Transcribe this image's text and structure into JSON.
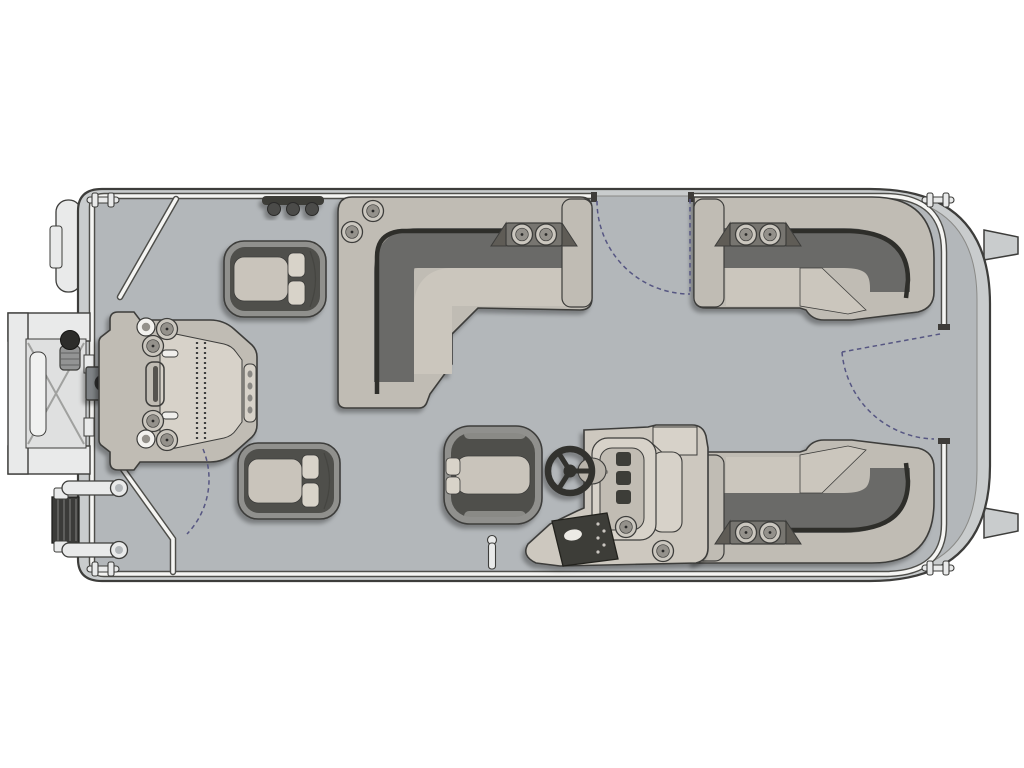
{
  "diagram": {
    "title": "Pontoon boat floor plan — overhead deck layout, bow at left",
    "view": "top-down"
  },
  "colors": {
    "bg": "#ffffff",
    "outline": "#3d3d3b",
    "seamDark": "#2d2d2b",
    "hull": "#c9cccd",
    "deck": "#b3b7ba",
    "deckEdge": "#8a8a87",
    "railWhite": "#f5f5f3",
    "railEdge": "#4e4e4a",
    "base": "#c0bcb4",
    "seat": "#cbc6bd",
    "back": "#6b6a67",
    "shell": "#90908d",
    "wrap": "#4f4f4c",
    "cushion": "#c9c4bb",
    "pad": "#d8d3c9",
    "panel": "#3e3c39",
    "console": "#cdc8bf",
    "consoleLight": "#d7d2c9",
    "metal": "#e9eaea",
    "metalDark": "#3b3b39",
    "pedestal": "#7f8386",
    "ring": "#cbc7bf",
    "ringInner": "#94918b",
    "arc": "#565682"
  },
  "components": {
    "hull": "Pontoon deck and hull",
    "perimeter_rail": "Perimeter fence rail",
    "bow_boarding_door": "Open bow-side boarding door",
    "boarding_ladder": "Folding boarding ladder",
    "bow_bumper": "Bow corner fender",
    "bow_console": "Bow console with cupholders, latch strip and handle",
    "table_pedestal": "Table pedestal floor mount",
    "captain_chair_forward": "Swivel bucket chair, forward, facing bow",
    "captain_chair_aft": "Swivel bucket chair, aft, facing bow",
    "helm_chair": "Helm bucket seat facing helm console",
    "helm_console": "Helm console with steering wheel, gauges, switch panel and cupholders",
    "steering_wheel": "Three-spoke steering wheel",
    "lounge_midship": "L-shaped lounge with cupholder armrest, midship",
    "lounge_aft_top": "Corner lounge with cupholder armrest, aft top",
    "lounge_aft_bottom": "Corner lounge with cupholder armrest, aft bottom",
    "gate_port": "Midship entry gate with swing arc",
    "gate_stern": "Stern entry gate with swing arc",
    "gate_bow": "Bow entry gate with swing arc",
    "cleats": "Mooring cleat",
    "stern_fins": "Stern transom brackets",
    "hinge_bar": "Gate hinge fittings",
    "ski_tow": "Ski tow / table post socket"
  }
}
